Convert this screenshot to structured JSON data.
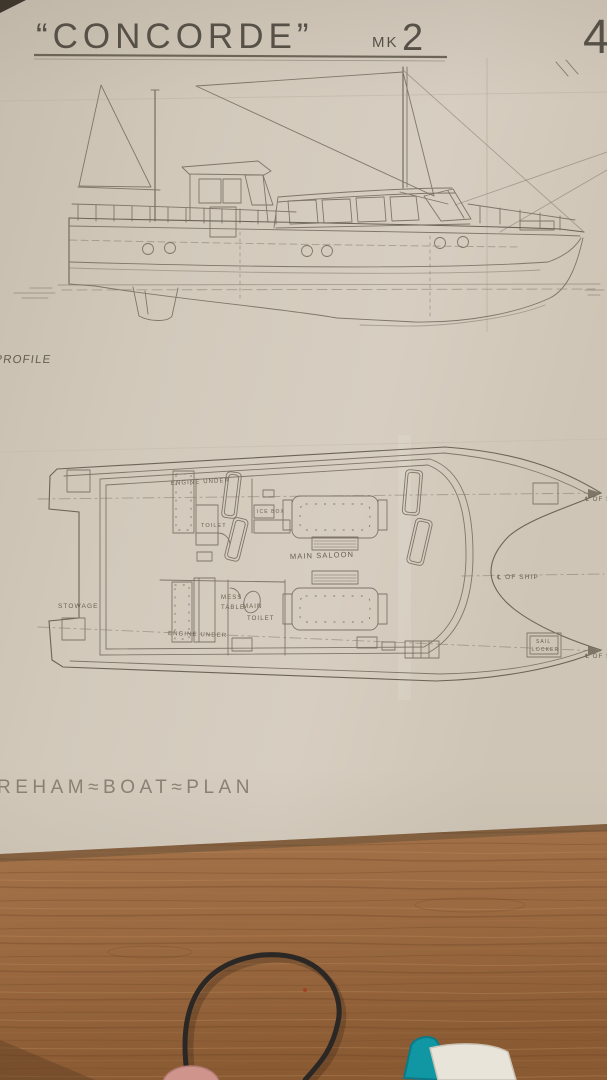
{
  "sheet": {
    "title_quoted": "“CONCORDE”",
    "mark": "MK",
    "mark_number": "2",
    "page_number": "4",
    "profile_label": "PROFILE",
    "plan_label": "PLAN",
    "caption": "REHAM≈BOAT≈PLAN"
  },
  "plan_labels": {
    "engine_top": "ENGINE UNDER",
    "toilet_top": "TOILET",
    "ice_box": "ICE BOX",
    "main_saloon": "MAIN SALOON",
    "mess_table_line1": "MESS",
    "mess_table_line2": "TABLE",
    "main_toilet_line1": "MAIN",
    "main_toilet_line2": "TOILET",
    "engine_bottom": "ENGINE UNDER",
    "stowage": "STOWAGE",
    "sail_locker_line1": "SAIL",
    "sail_locker_line2": "LOCKER",
    "centerline_mid": "℄ OF SHIP",
    "centerline_top": "℄ OF SH",
    "centerline_bottom": "℄ OF S"
  }
}
